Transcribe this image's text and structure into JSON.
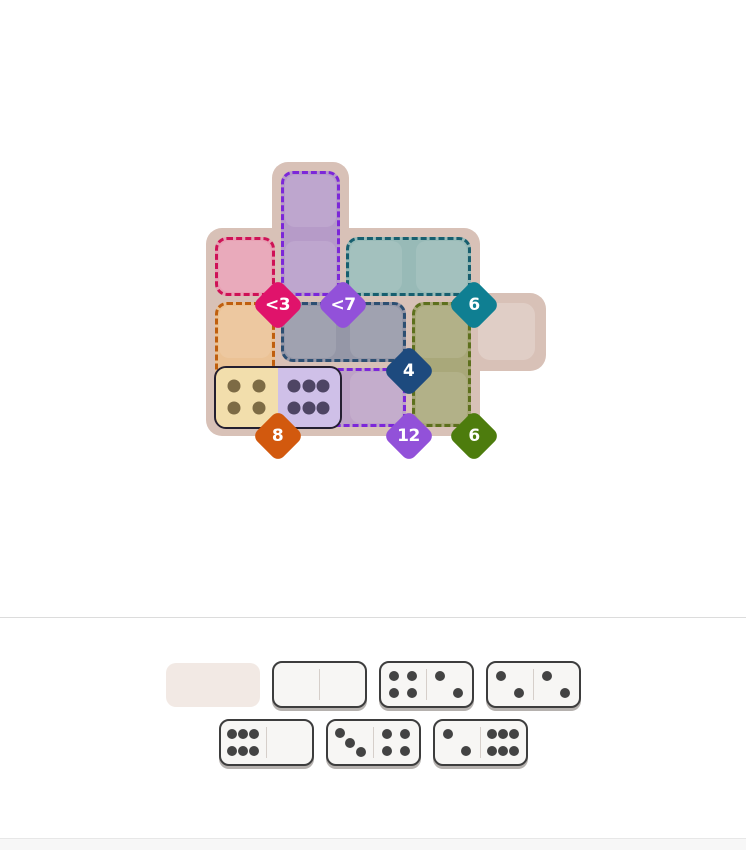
{
  "board": {
    "board_color": "#d8c1b7",
    "grid": {
      "cols": 5,
      "rows": 4
    },
    "free_cells": [
      {
        "col": 4,
        "row": 2
      }
    ],
    "regions": [
      {
        "name": "rose",
        "constraint": "<3",
        "fill": "#e7a0b3",
        "border": "#ce1256",
        "badge_color": "#e0136b",
        "cells": [
          {
            "col": 0,
            "row": 1
          }
        ]
      },
      {
        "name": "violet",
        "constraint": "<7",
        "fill": "#b69bc8",
        "border": "#7c27d9",
        "badge_color": "#9251d9",
        "cells": [
          {
            "col": 1,
            "row": 0
          },
          {
            "col": 1,
            "row": 1
          }
        ]
      },
      {
        "name": "teal",
        "constraint": "6",
        "fill": "#98bab7",
        "border": "#175f6f",
        "badge_color": "#0f7f92",
        "cells": [
          {
            "col": 2,
            "row": 1
          },
          {
            "col": 3,
            "row": 1
          }
        ]
      },
      {
        "name": "amber",
        "constraint": "8",
        "fill": "#ebc295",
        "border": "#bf5f0e",
        "badge_color": "#d2590e",
        "cells": [
          {
            "col": 0,
            "row": 2
          },
          {
            "col": 0,
            "row": 3
          }
        ]
      },
      {
        "name": "slate",
        "constraint": "4",
        "fill": "#9597a7",
        "border": "#2d4f72",
        "badge_color": "#1d4a7e",
        "cells": [
          {
            "col": 1,
            "row": 2
          },
          {
            "col": 2,
            "row": 2
          }
        ]
      },
      {
        "name": "olive",
        "constraint": "6",
        "fill": "#a9a87a",
        "border": "#5d701d",
        "badge_color": "#4d7c0d",
        "cells": [
          {
            "col": 3,
            "row": 2
          },
          {
            "col": 3,
            "row": 3
          }
        ]
      },
      {
        "name": "mauve",
        "constraint": "12",
        "fill": "#bda3c6",
        "border": "#7c27d9",
        "badge_color": "#9251d9",
        "cells": [
          {
            "col": 1,
            "row": 3
          },
          {
            "col": 2,
            "row": 3
          }
        ]
      }
    ],
    "placed_dominoes": [
      {
        "pips": [
          4,
          6
        ],
        "cells": [
          {
            "col": 0,
            "row": 3
          },
          {
            "col": 1,
            "row": 3
          }
        ],
        "half_colors": [
          "#f2deac",
          "#cfc0e8"
        ],
        "pip_colors": [
          "#7d6b45",
          "#4e4564"
        ]
      }
    ]
  },
  "tray": {
    "pip_color": "#434343",
    "rows": [
      [
        {
          "type": "empty-slot"
        },
        {
          "type": "domino",
          "pips": [
            0,
            0
          ]
        },
        {
          "type": "domino",
          "pips": [
            4,
            2
          ]
        },
        {
          "type": "domino",
          "pips": [
            2,
            2
          ]
        }
      ],
      [
        {
          "type": "domino",
          "pips": [
            6,
            0
          ]
        },
        {
          "type": "domino",
          "pips": [
            3,
            4
          ]
        },
        {
          "type": "domino",
          "pips": [
            2,
            6
          ]
        }
      ]
    ]
  }
}
